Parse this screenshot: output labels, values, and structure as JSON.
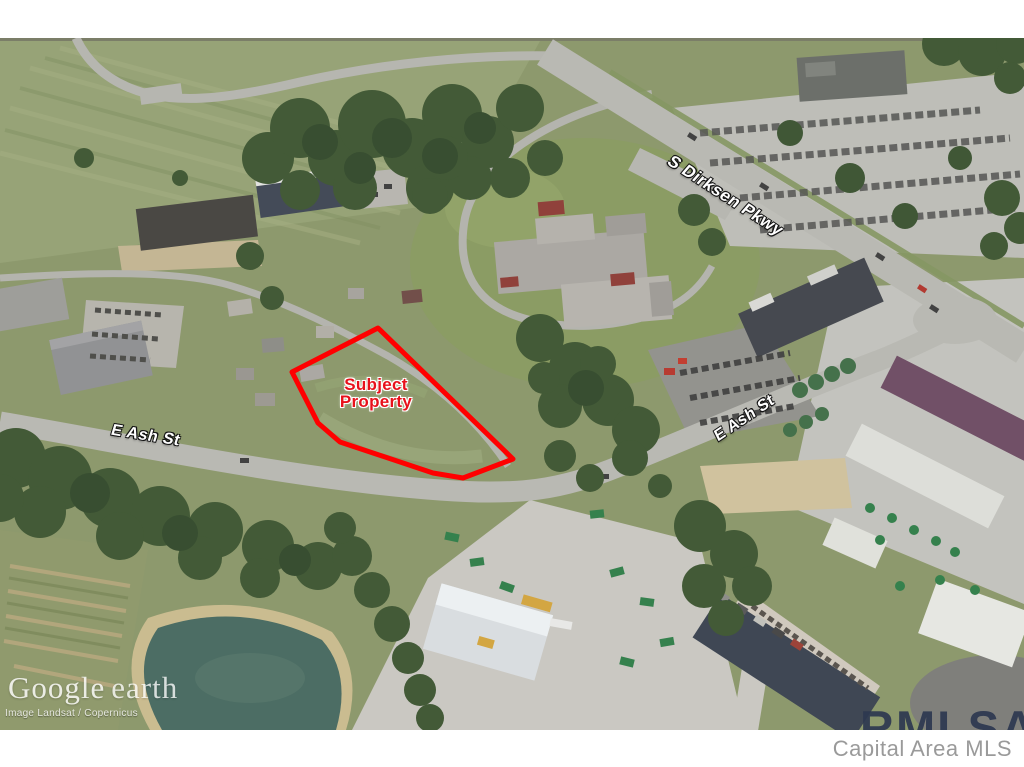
{
  "annotations": {
    "subject_property": {
      "line1": "Subject",
      "line2": "Property",
      "outline_color": "#ff0000",
      "text_color": "#e8111b"
    },
    "streets": [
      {
        "id": "s-dirksen-pkwy",
        "label": "S Dirksen Pkwy"
      },
      {
        "id": "e-ash-st-west",
        "label": "E Ash St"
      },
      {
        "id": "e-ash-st-east",
        "label": "E Ash St"
      }
    ]
  },
  "watermarks": {
    "google_logo": "Google",
    "google_product": "earth",
    "attribution": "Image Landsat / Copernicus",
    "mls_overlay": "RMLSA",
    "mls_overlay_color": "#2d3850",
    "mls_caption": "Capital Area MLS",
    "mls_caption_color": "#9a9a9a"
  }
}
